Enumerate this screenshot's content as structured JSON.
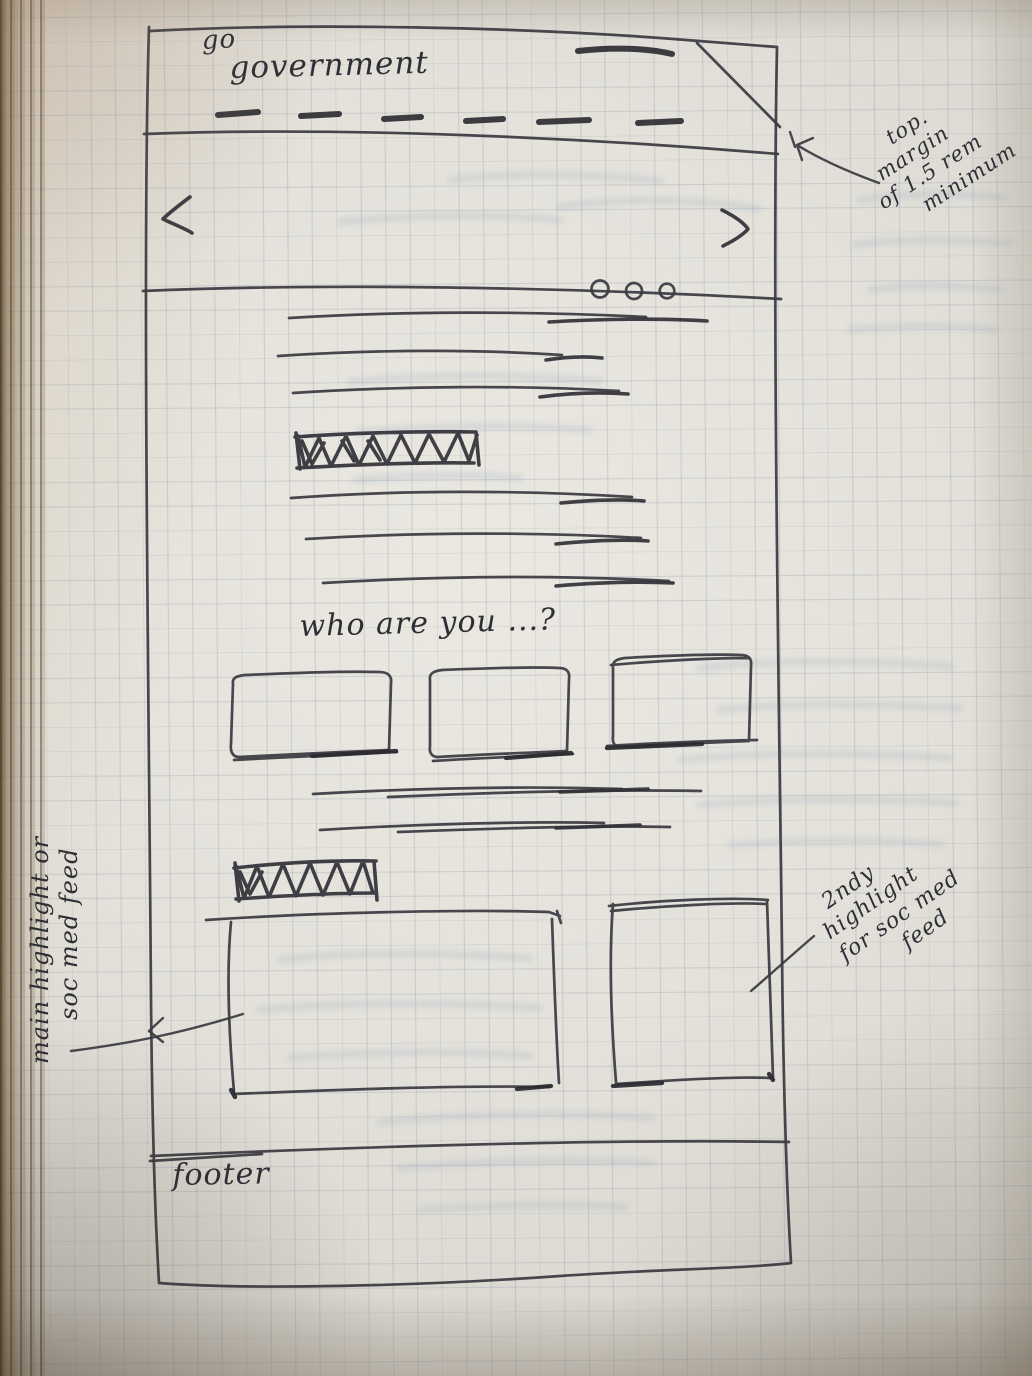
{
  "sketch": {
    "logo": {
      "top": "go",
      "main": "government"
    },
    "nav": {
      "style_note": "dashed menu placeholder"
    },
    "carousel": {
      "prev_icon": "chevron-left",
      "next_icon": "chevron-right",
      "dot_count": 3
    },
    "headings": {
      "question": "who are you ...?"
    },
    "footer": {
      "label": "footer"
    }
  },
  "annotations": {
    "top_note": {
      "lines": [
        "top.",
        "margin",
        "of 1.5 rem",
        "minimum"
      ]
    },
    "left_note": {
      "lines": [
        "main highlight or",
        "soc med feed"
      ]
    },
    "right_note": {
      "lines": [
        "2ndy",
        "highlight",
        "for soc med",
        "feed"
      ]
    }
  },
  "colors": {
    "pen": "#32323a",
    "paper": "#e4e2db",
    "grid_line": "#7a89a0"
  }
}
